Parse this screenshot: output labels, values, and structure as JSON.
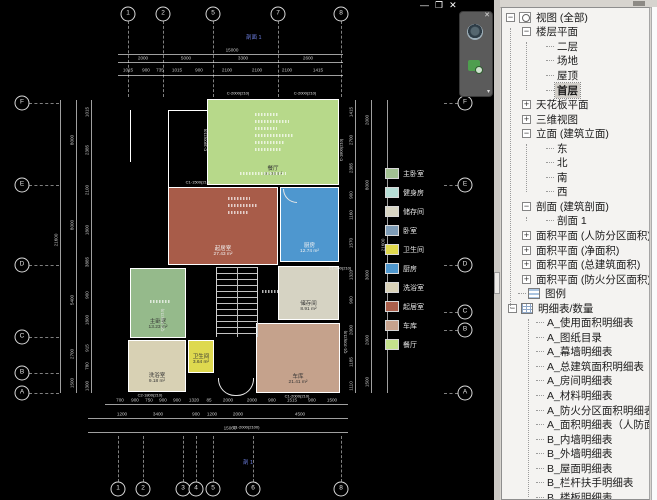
{
  "window": {
    "minimize": "—",
    "restore": "❐",
    "close": "✕"
  },
  "navbar": {
    "close": "✕",
    "chevron": "▾",
    "wheel_icon": "steering-wheel-icon",
    "zoom_icon": "zoom-region-icon"
  },
  "section_marks": [
    {
      "text": "剖面 1",
      "x": 246,
      "y": 33
    },
    {
      "text": "剖 1",
      "x": 243,
      "y": 458
    }
  ],
  "legend": {
    "items": [
      {
        "label": "主卧室",
        "color": "#a3c193"
      },
      {
        "label": "健身房",
        "color": "#b7ded6"
      },
      {
        "label": "储存间",
        "color": "#d8d5c4"
      },
      {
        "label": "卧室",
        "color": "#7e9cb6"
      },
      {
        "label": "卫生间",
        "color": "#e0d94d"
      },
      {
        "label": "厨房",
        "color": "#4f97cd"
      },
      {
        "label": "洗浴室",
        "color": "#d9d2b8"
      },
      {
        "label": "起居室",
        "color": "#aa5f4b"
      },
      {
        "label": "车库",
        "color": "#c6a28d"
      },
      {
        "label": "餐厅",
        "color": "#c4e18c"
      }
    ]
  },
  "plan": {
    "rooms": [
      {
        "name": "餐厅",
        "area": "46.08 m²",
        "x": 207,
        "y": 99,
        "w": 132,
        "h": 86,
        "color": "#b7d98a",
        "dark": false
      },
      {
        "name": "起居室",
        "area": "27.43 m²",
        "x": 168,
        "y": 187,
        "w": 110,
        "h": 78,
        "color": "#a85c49",
        "dark": true
      },
      {
        "name": "厨房",
        "area": "12.74 m²",
        "x": 280,
        "y": 187,
        "w": 59,
        "h": 75,
        "color": "#4e97cf",
        "dark": true
      },
      {
        "name": "主卧室",
        "area": "13.23 m²",
        "x": 130,
        "y": 268,
        "w": 56,
        "h": 70,
        "color": "#95ba8b",
        "dark": false
      },
      {
        "name": "储存间",
        "area": "8.91 m²",
        "x": 278,
        "y": 266,
        "w": 61,
        "h": 54,
        "color": "#d6d3c3",
        "dark": false
      },
      {
        "name": "洗浴室",
        "area": "9.18 m²",
        "x": 128,
        "y": 340,
        "w": 58,
        "h": 52,
        "color": "#d8d1b4",
        "dark": false
      },
      {
        "name": "卫生间",
        "area": "3.64 m²",
        "x": 188,
        "y": 340,
        "w": 26,
        "h": 33,
        "color": "#ded94f",
        "dark": false
      },
      {
        "name": "车库",
        "area": "21.41 m²",
        "x": 256,
        "y": 323,
        "w": 84,
        "h": 70,
        "color": "#c5a28c",
        "dark": false
      }
    ],
    "grid": {
      "top": [
        {
          "x": 128,
          "label": "1"
        },
        {
          "x": 163,
          "label": "2"
        },
        {
          "x": 213,
          "label": "5"
        },
        {
          "x": 278,
          "label": "7"
        },
        {
          "x": 341,
          "label": "8"
        }
      ],
      "bottom": [
        {
          "x": 118,
          "label": "1"
        },
        {
          "x": 143,
          "label": "2"
        },
        {
          "x": 183,
          "label": "3"
        },
        {
          "x": 196,
          "label": "4"
        },
        {
          "x": 213,
          "label": "5"
        },
        {
          "x": 253,
          "label": "6"
        },
        {
          "x": 341,
          "label": "8"
        }
      ],
      "left": [
        {
          "y": 103,
          "label": "F"
        },
        {
          "y": 185,
          "label": "E"
        },
        {
          "y": 265,
          "label": "D"
        },
        {
          "y": 337,
          "label": "C"
        },
        {
          "y": 373,
          "label": "B"
        },
        {
          "y": 393,
          "label": "A"
        }
      ],
      "right": [
        {
          "y": 103,
          "label": "F"
        },
        {
          "y": 185,
          "label": "E"
        },
        {
          "y": 265,
          "label": "D"
        },
        {
          "y": 312,
          "label": "C"
        },
        {
          "y": 330,
          "label": "B"
        },
        {
          "y": 393,
          "label": "A"
        }
      ]
    },
    "dim_lines": {
      "h": [
        {
          "x": 118,
          "y": 54,
          "len": 225
        },
        {
          "x": 118,
          "y": 62,
          "len": 225
        },
        {
          "x": 118,
          "y": 75,
          "len": 225
        },
        {
          "x": 105,
          "y": 404,
          "len": 243
        },
        {
          "x": 88,
          "y": 418,
          "len": 260
        },
        {
          "x": 88,
          "y": 432,
          "len": 260
        }
      ],
      "v": [
        {
          "x": 60,
          "y": 100,
          "len": 293
        },
        {
          "x": 76,
          "y": 100,
          "len": 293
        },
        {
          "x": 91,
          "y": 100,
          "len": 293
        },
        {
          "x": 355,
          "y": 100,
          "len": 293
        },
        {
          "x": 371,
          "y": 100,
          "len": 293
        },
        {
          "x": 387,
          "y": 100,
          "len": 293
        }
      ]
    },
    "dim_labels": {
      "top": [
        {
          "x": 232,
          "y": 50,
          "t": "15000"
        },
        {
          "x": 143,
          "y": 58,
          "t": "2000"
        },
        {
          "x": 186,
          "y": 58,
          "t": "5000"
        },
        {
          "x": 243,
          "y": 58,
          "t": "3300"
        },
        {
          "x": 308,
          "y": 58,
          "t": "2600"
        },
        {
          "x": 128,
          "y": 70,
          "t": "1015"
        },
        {
          "x": 146,
          "y": 70,
          "t": "900"
        },
        {
          "x": 160,
          "y": 70,
          "t": "735"
        },
        {
          "x": 177,
          "y": 70,
          "t": "1015"
        },
        {
          "x": 199,
          "y": 70,
          "t": "900"
        },
        {
          "x": 227,
          "y": 70,
          "t": "2100"
        },
        {
          "x": 257,
          "y": 70,
          "t": "2100"
        },
        {
          "x": 287,
          "y": 70,
          "t": "2100"
        },
        {
          "x": 318,
          "y": 70,
          "t": "1415"
        }
      ],
      "bottom": [
        {
          "x": 120,
          "y": 400,
          "t": "700"
        },
        {
          "x": 135,
          "y": 400,
          "t": "900"
        },
        {
          "x": 149,
          "y": 400,
          "t": "750"
        },
        {
          "x": 163,
          "y": 400,
          "t": "900"
        },
        {
          "x": 177,
          "y": 400,
          "t": "900"
        },
        {
          "x": 194,
          "y": 400,
          "t": "1320"
        },
        {
          "x": 209,
          "y": 400,
          "t": "85"
        },
        {
          "x": 228,
          "y": 400,
          "t": "2000"
        },
        {
          "x": 252,
          "y": 400,
          "t": "2000"
        },
        {
          "x": 272,
          "y": 400,
          "t": "900"
        },
        {
          "x": 292,
          "y": 400,
          "t": "1515"
        },
        {
          "x": 312,
          "y": 400,
          "t": "900"
        },
        {
          "x": 332,
          "y": 400,
          "t": "1500"
        },
        {
          "x": 122,
          "y": 414,
          "t": "1200"
        },
        {
          "x": 158,
          "y": 414,
          "t": "3400"
        },
        {
          "x": 196,
          "y": 414,
          "t": "900"
        },
        {
          "x": 212,
          "y": 414,
          "t": "1200"
        },
        {
          "x": 238,
          "y": 414,
          "t": "2000"
        },
        {
          "x": 300,
          "y": 414,
          "t": "4500"
        },
        {
          "x": 230,
          "y": 428,
          "t": "15000"
        }
      ],
      "left": [
        {
          "x": 56,
          "y": 240,
          "t": "21600"
        },
        {
          "x": 72,
          "y": 140,
          "t": "8000"
        },
        {
          "x": 72,
          "y": 225,
          "t": "8000"
        },
        {
          "x": 72,
          "y": 300,
          "t": "5400"
        },
        {
          "x": 72,
          "y": 354,
          "t": "2700"
        },
        {
          "x": 72,
          "y": 383,
          "t": "1500"
        },
        {
          "x": 87,
          "y": 112,
          "t": "1015"
        },
        {
          "x": 87,
          "y": 150,
          "t": "2385"
        },
        {
          "x": 87,
          "y": 190,
          "t": "2100"
        },
        {
          "x": 87,
          "y": 230,
          "t": "1800"
        },
        {
          "x": 87,
          "y": 262,
          "t": "3885"
        },
        {
          "x": 87,
          "y": 295,
          "t": "900"
        },
        {
          "x": 87,
          "y": 320,
          "t": "1800"
        },
        {
          "x": 87,
          "y": 348,
          "t": "915"
        },
        {
          "x": 87,
          "y": 366,
          "t": "780"
        },
        {
          "x": 87,
          "y": 386,
          "t": "1300"
        }
      ],
      "right": [
        {
          "x": 351,
          "y": 112,
          "t": "1415"
        },
        {
          "x": 351,
          "y": 140,
          "t": "2700"
        },
        {
          "x": 351,
          "y": 168,
          "t": "2385"
        },
        {
          "x": 351,
          "y": 195,
          "t": "900"
        },
        {
          "x": 351,
          "y": 215,
          "t": "1160"
        },
        {
          "x": 351,
          "y": 243,
          "t": "1570"
        },
        {
          "x": 351,
          "y": 275,
          "t": "1320"
        },
        {
          "x": 351,
          "y": 300,
          "t": "900"
        },
        {
          "x": 351,
          "y": 330,
          "t": "2000"
        },
        {
          "x": 351,
          "y": 362,
          "t": "1185"
        },
        {
          "x": 351,
          "y": 386,
          "t": "1110"
        },
        {
          "x": 367,
          "y": 120,
          "t": "2000"
        },
        {
          "x": 367,
          "y": 185,
          "t": "8000"
        },
        {
          "x": 367,
          "y": 275,
          "t": "3000"
        },
        {
          "x": 367,
          "y": 340,
          "t": "2000"
        },
        {
          "x": 367,
          "y": 382,
          "t": "1500"
        },
        {
          "x": 383,
          "y": 245,
          "t": "21600"
        }
      ]
    },
    "wall_tags": [
      {
        "x": 238,
        "y": 93,
        "t": "C-2000(210)",
        "rot": false
      },
      {
        "x": 305,
        "y": 93,
        "t": "C-2000(210)",
        "rot": false
      },
      {
        "x": 205,
        "y": 140,
        "t": "C-1800(210)",
        "rot": true
      },
      {
        "x": 341,
        "y": 150,
        "t": "C-1800(210)",
        "rot": true
      },
      {
        "x": 198,
        "y": 182,
        "t": "C1-1500(210)",
        "rot": false
      },
      {
        "x": 340,
        "y": 268,
        "t": "C1-900(210)",
        "rot": false
      },
      {
        "x": 162,
        "y": 320,
        "t": "Q1-200(210)",
        "rot": true
      },
      {
        "x": 345,
        "y": 342,
        "t": "Q1-200(210)",
        "rot": true
      },
      {
        "x": 150,
        "y": 395,
        "t": "C2-1800(210)",
        "rot": false
      },
      {
        "x": 246,
        "y": 427,
        "t": "C1-2000(2100)",
        "rot": false
      },
      {
        "x": 297,
        "y": 396,
        "t": "C1-2000(210)",
        "rot": false
      }
    ],
    "micro_marks": [
      {
        "x": 255,
        "y": 113,
        "w": 24
      },
      {
        "x": 255,
        "y": 120,
        "w": 34
      },
      {
        "x": 255,
        "y": 127,
        "w": 22
      },
      {
        "x": 255,
        "y": 134,
        "w": 38
      },
      {
        "x": 255,
        "y": 141,
        "w": 30
      },
      {
        "x": 255,
        "y": 148,
        "w": 26
      },
      {
        "x": 240,
        "y": 172,
        "w": 46
      },
      {
        "x": 228,
        "y": 197,
        "w": 22
      },
      {
        "x": 228,
        "y": 204,
        "w": 30
      },
      {
        "x": 228,
        "y": 211,
        "w": 20
      },
      {
        "x": 262,
        "y": 290,
        "w": 18
      },
      {
        "x": 150,
        "y": 300,
        "w": 20
      }
    ],
    "extra_walls": [
      {
        "x": 168,
        "y": 110,
        "w": 40,
        "h": 1
      },
      {
        "x": 130,
        "y": 110,
        "w": 1,
        "h": 52
      },
      {
        "x": 168,
        "y": 110,
        "w": 1,
        "h": 77
      }
    ]
  },
  "browser": {
    "items": [
      {
        "label": "视图 (全部)",
        "indent": 4,
        "exp": "-",
        "icon": "views"
      },
      {
        "label": "楼层平面",
        "indent": 20,
        "exp": "-"
      },
      {
        "label": "二层",
        "indent": 44,
        "stub": true
      },
      {
        "label": "场地",
        "indent": 44,
        "stub": true
      },
      {
        "label": "屋顶",
        "indent": 44,
        "stub": true
      },
      {
        "label": "首层",
        "indent": 44,
        "stub": true,
        "selected": true
      },
      {
        "label": "天花板平面",
        "indent": 20,
        "exp": "+"
      },
      {
        "label": "三维视图",
        "indent": 20,
        "exp": "+"
      },
      {
        "label": "立面 (建筑立面)",
        "indent": 20,
        "exp": "-"
      },
      {
        "label": "东",
        "indent": 44,
        "stub": true
      },
      {
        "label": "北",
        "indent": 44,
        "stub": true
      },
      {
        "label": "南",
        "indent": 44,
        "stub": true
      },
      {
        "label": "西",
        "indent": 44,
        "stub": true
      },
      {
        "label": "剖面 (建筑剖面)",
        "indent": 20,
        "exp": "-"
      },
      {
        "label": "剖面 1",
        "indent": 44,
        "stub": true
      },
      {
        "label": "面积平面 (人防分区面积)",
        "indent": 20,
        "exp": "+"
      },
      {
        "label": "面积平面 (净面积)",
        "indent": 20,
        "exp": "+"
      },
      {
        "label": "面积平面 (总建筑面积)",
        "indent": 20,
        "exp": "+"
      },
      {
        "label": "面积平面 (防火分区面积)",
        "indent": 20,
        "exp": "+"
      },
      {
        "label": "图例",
        "indent": 16,
        "icon": "legend",
        "stub": true
      },
      {
        "label": "明细表/数量",
        "indent": 6,
        "exp": "-",
        "icon": "table"
      },
      {
        "label": "A_使用面积明细表",
        "indent": 34,
        "stub": true
      },
      {
        "label": "A_图纸目录",
        "indent": 34,
        "stub": true
      },
      {
        "label": "A_幕墙明细表",
        "indent": 34,
        "stub": true
      },
      {
        "label": "A_总建筑面积明细表",
        "indent": 34,
        "stub": true
      },
      {
        "label": "A_房间明细表",
        "indent": 34,
        "stub": true
      },
      {
        "label": "A_材料明细表",
        "indent": 34,
        "stub": true
      },
      {
        "label": "A_防火分区面积明细表",
        "indent": 34,
        "stub": true
      },
      {
        "label": "A_面积明细表（人防面积）",
        "indent": 34,
        "stub": true
      },
      {
        "label": "B_内墙明细表",
        "indent": 34,
        "stub": true
      },
      {
        "label": "B_外墙明细表",
        "indent": 34,
        "stub": true
      },
      {
        "label": "B_屋面明细表",
        "indent": 34,
        "stub": true
      },
      {
        "label": "B_栏杆扶手明细表",
        "indent": 34,
        "stub": true
      },
      {
        "label": "B_楼板明细表",
        "indent": 34,
        "stub": true
      }
    ],
    "spines": [
      {
        "x": 8,
        "from": 1,
        "to": 20
      },
      {
        "x": 24,
        "from": 2,
        "to": 5
      },
      {
        "x": 24,
        "from": 9,
        "to": 12
      },
      {
        "x": 24,
        "from": 14,
        "to": 14
      },
      {
        "x": 26,
        "from": 21,
        "to": 33
      }
    ]
  }
}
